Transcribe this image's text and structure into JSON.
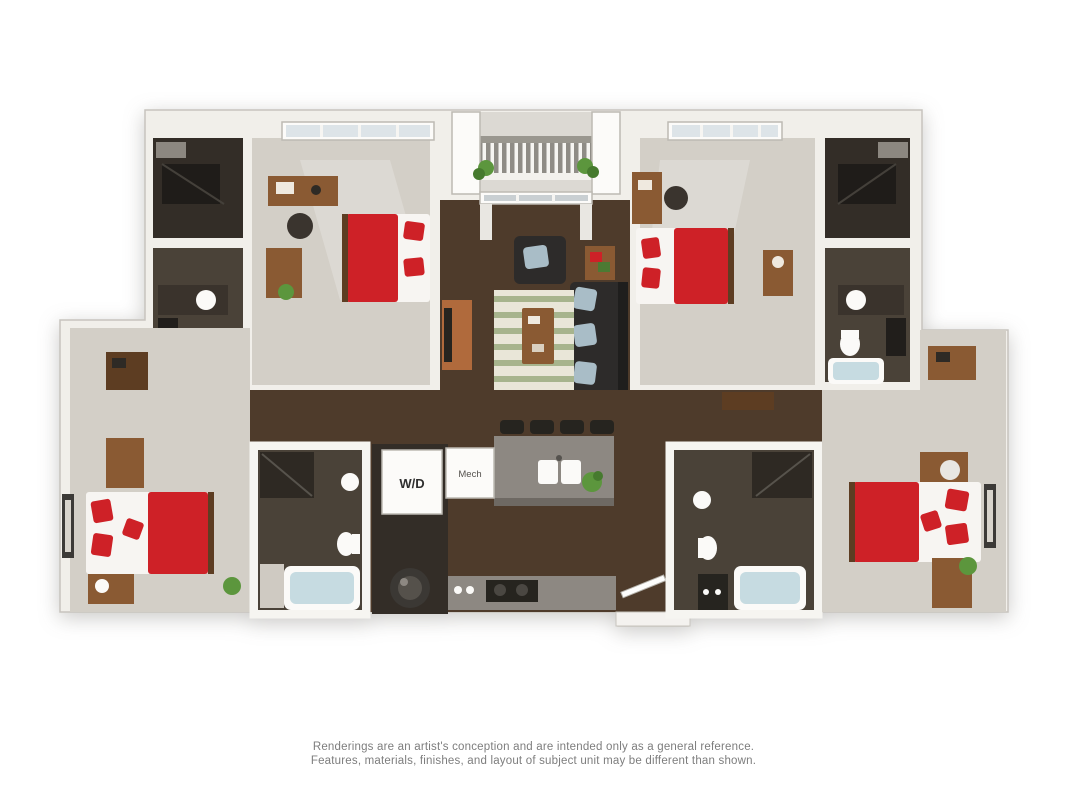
{
  "floorplan": {
    "labels": {
      "washer_dryer": "W/D",
      "mechanical": "Mech"
    },
    "colors": {
      "wall": "#f1efea",
      "wall_edge": "#c7c4be",
      "carpet": "#d3cfc7",
      "wood": "#4e3b2b",
      "bath_floor": "#4a4238",
      "closet_floor": "#332d27",
      "bed_red": "#ce2127",
      "bed_white": "#f7f5f2",
      "sofa": "#2d2b2a",
      "pillow_blue": "#a9bdc7",
      "rug_base": "#e9e6d8",
      "rug_stripe": "#a7b48d",
      "counter": "#8d8882",
      "counter_shade": "#6e6963",
      "tub": "#c6dbe1",
      "porcelain": "#fbfaf8",
      "plant": "#5c963d",
      "wood_furniture": "#8a5a33",
      "wood_dark": "#5d3d22",
      "appliance": "#26241f",
      "window_glass": "#dde4e8",
      "white_box": "#fcfbf9",
      "frame_dark": "#3c3a37",
      "label_dark": "#2f2f2f",
      "text_gray": "#7d7d7d"
    }
  },
  "disclaimer": {
    "line1": "Renderings are an artist's conception and are intended only as a general reference.",
    "line2": "Features, materials, finishes, and layout of subject unit may be different than shown."
  }
}
